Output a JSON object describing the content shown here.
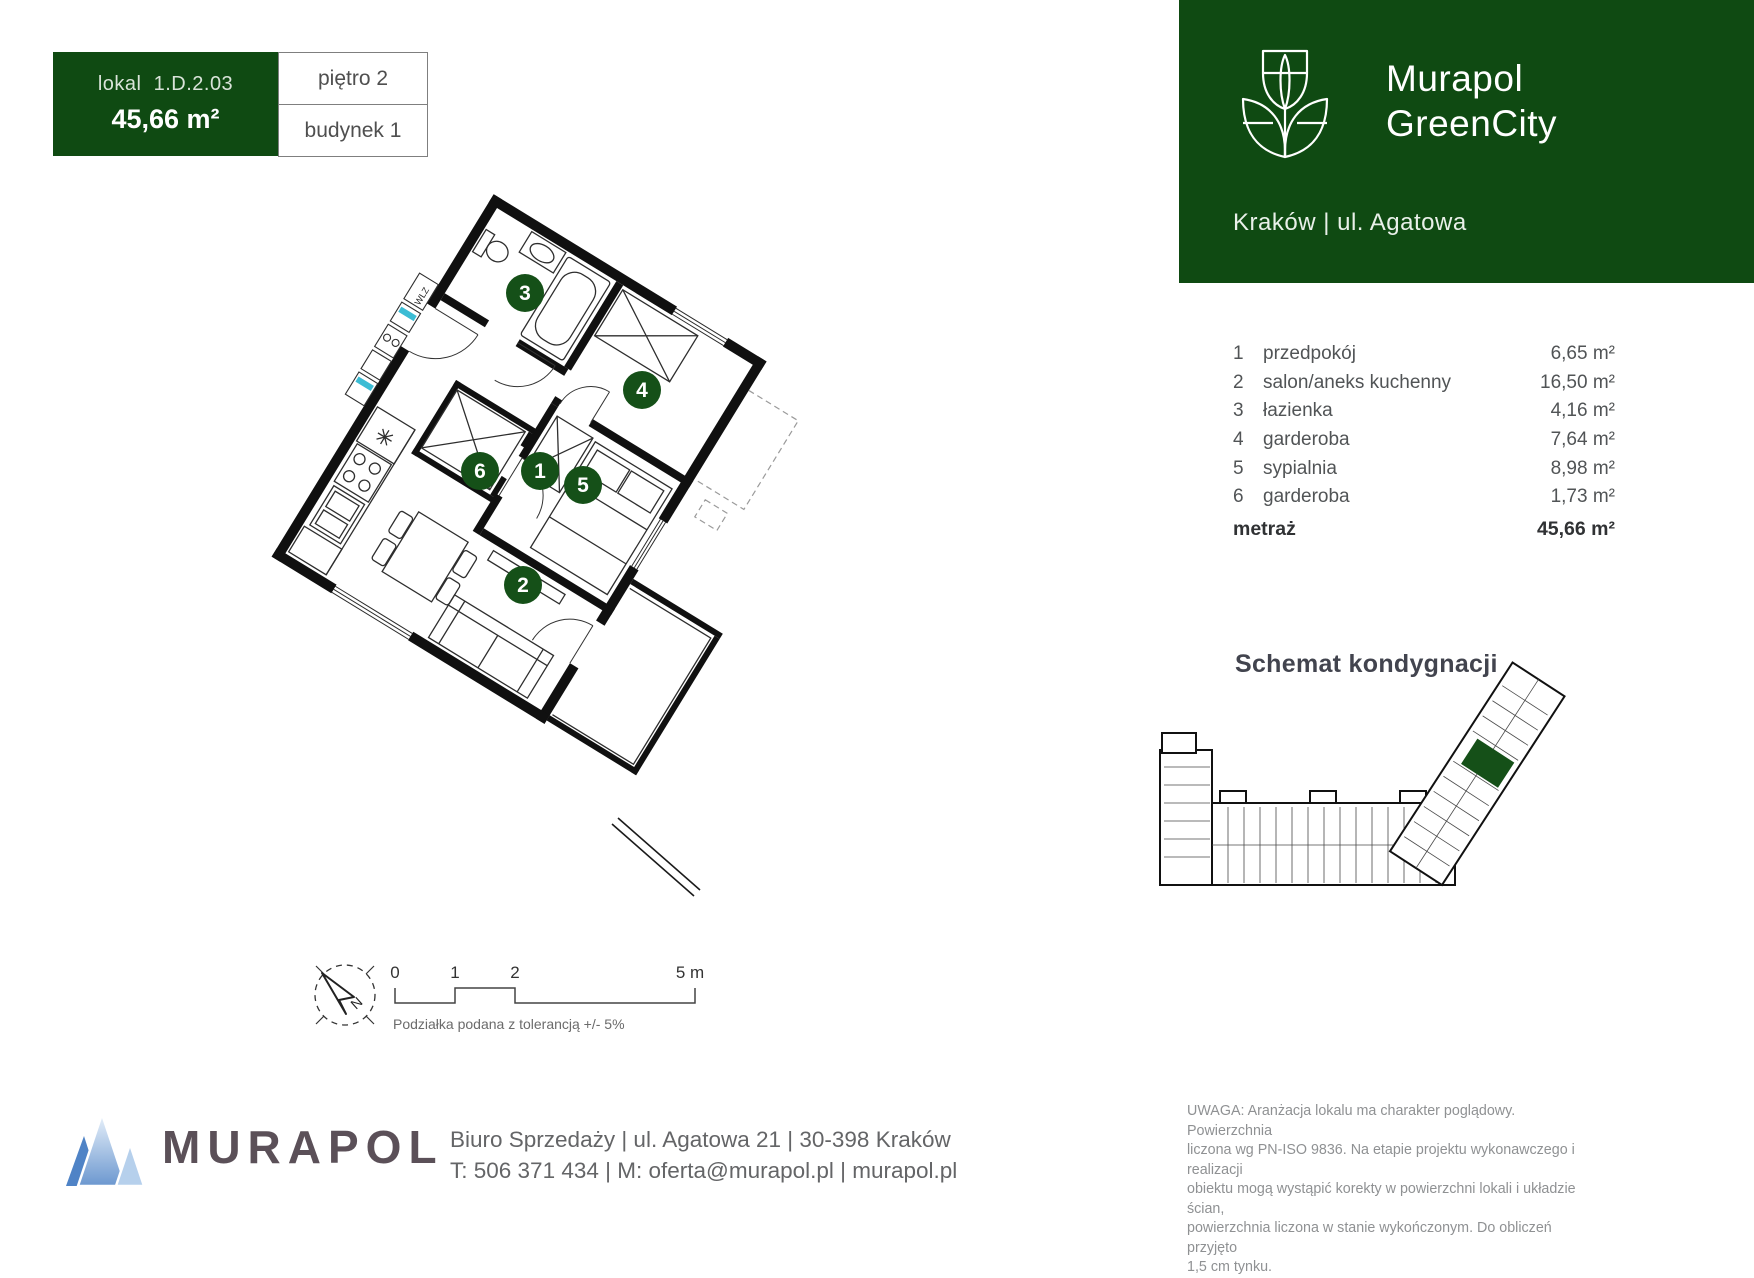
{
  "unit_card": {
    "label": "lokal",
    "code": "1.D.2.03",
    "area": "45,66 m²",
    "floor": "piętro 2",
    "building": "budynek 1"
  },
  "brand": {
    "name_line1": "Murapol",
    "name_line2": "GreenCity",
    "location": "Kraków | ul. Agatowa"
  },
  "rooms": {
    "items": [
      {
        "no": "1",
        "name": "przedpokój",
        "area": "6,65 m²"
      },
      {
        "no": "2",
        "name": "salon/aneks kuchenny",
        "area": "16,50 m²"
      },
      {
        "no": "3",
        "name": "łazienka",
        "area": "4,16 m²"
      },
      {
        "no": "4",
        "name": "garderoba",
        "area": "7,64 m²"
      },
      {
        "no": "5",
        "name": "sypialnia",
        "area": "8,98 m²"
      },
      {
        "no": "6",
        "name": "garderoba",
        "area": "1,73 m²"
      }
    ],
    "total_label": "metraż",
    "total_area": "45,66 m²"
  },
  "floor_schematic": {
    "title": "Schemat kondygnacji"
  },
  "plan": {
    "badges": [
      "1",
      "2",
      "3",
      "4",
      "5",
      "6"
    ],
    "wlz_label": "WLZ"
  },
  "scale_bar": {
    "ticks": [
      "0",
      "1",
      "2",
      "5 m"
    ],
    "note": "Podziałka podana z tolerancją +/- 5%"
  },
  "compass": {
    "north_label": "N"
  },
  "footer": {
    "wordmark": "MURAPOL",
    "address": "Biuro Sprzedaży | ul. Agatowa 21 | 30-398 Kraków",
    "contact": "T: 506 371 434 | M: oferta@murapol.pl | murapol.pl"
  },
  "disclaimer": {
    "text": "UWAGA: Aranżacja lokalu ma charakter poglądowy.  Powierzchnia\nliczona wg PN-ISO 9836.  Na etapie projektu wykonawczego i realizacji\nobiektu mogą wystąpić korekty w powierzchni lokali i układzie  ścian,\npowierzchnia liczona w stanie wykończonym.  Do obliczeń przyjęto\n1,5 cm tynku."
  },
  "colors": {
    "brand_green": "#0f4a12",
    "badge_green": "#155018",
    "accent_cyan": "#3bbcd4",
    "murapol_wordmark": "#5b5058"
  }
}
